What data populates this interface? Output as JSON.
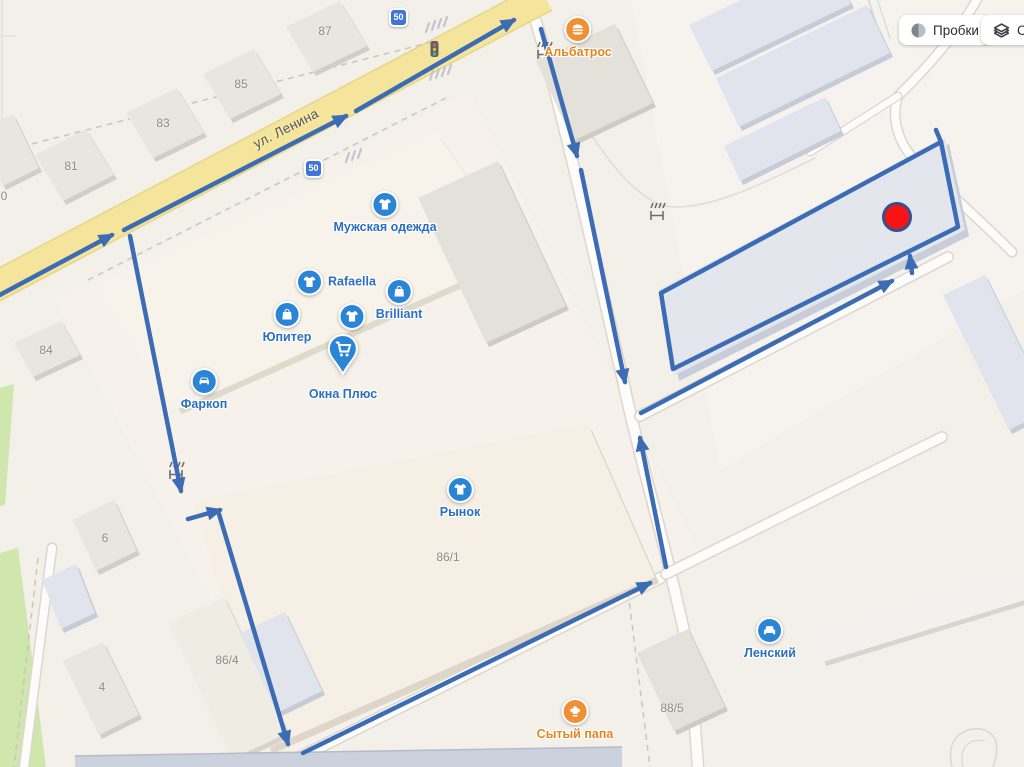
{
  "controls": {
    "traffic_label": "Пробки",
    "layers_label": "Сл"
  },
  "map": {
    "street_name": "ул. Ленина",
    "speed_limit_sign": "50",
    "building_numbers": [
      "87",
      "85",
      "83",
      "81",
      "0",
      "84",
      "6",
      "4",
      "86/1",
      "86/4",
      "88/5"
    ],
    "pois": [
      {
        "label": "Альбатрос",
        "icon": "burger-icon",
        "color": "#f09035"
      },
      {
        "label": "Мужская одежда",
        "icon": "tshirt-icon",
        "color": "#2b85d6"
      },
      {
        "label": "Rafaella",
        "icon": "tshirt-icon",
        "color": "#2b85d6"
      },
      {
        "label": "Brilliant",
        "icon": "shopping-bag-icon",
        "color": "#2b85d6"
      },
      {
        "label": "Юпитер",
        "icon": "shopping-bag-icon",
        "color": "#2b85d6"
      },
      {
        "label": "",
        "icon": "tshirt-icon",
        "color": "#2b85d6"
      },
      {
        "label": "Окна Плюс",
        "icon": "shopping-cart-icon",
        "color": "#2b85d6"
      },
      {
        "label": "Фаркоп",
        "icon": "car-icon",
        "color": "#2b85d6"
      },
      {
        "label": "Рынок",
        "icon": "tshirt-icon",
        "color": "#2b85d6"
      },
      {
        "label": "Сытый папа",
        "icon": "chef-hat-icon",
        "color": "#f09035"
      },
      {
        "label": "Ленский",
        "icon": "armchair-icon",
        "color": "#2b85d6"
      }
    ],
    "colors": {
      "route": "#3b6cb4",
      "road_yellow": "#f5e49b",
      "marker_red": "#fb1313",
      "poi_blue": "#2b85d6",
      "poi_orange": "#f09035",
      "background": "#f3f0ea"
    }
  }
}
